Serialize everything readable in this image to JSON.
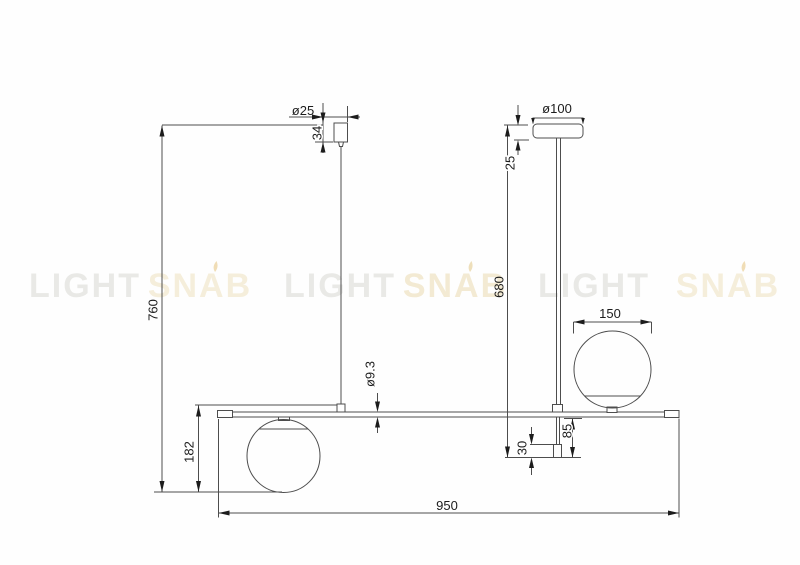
{
  "title": "Pendant lamp technical dimension drawing",
  "watermark": {
    "words": [
      "LIGHT",
      "SNAB",
      "LIGHT",
      "SNAB",
      "LIGHT",
      "SNAB"
    ],
    "gray_color": "#e9e9e6",
    "cream_color": "#f5eedb",
    "flame_color": "#f0ddb6"
  },
  "dimensions": {
    "small_canopy_diameter": "ø25",
    "small_canopy_height": "34",
    "large_canopy_diameter": "ø100",
    "large_canopy_height": "25",
    "total_height": "760",
    "rod_total_drop": "680",
    "bar_diameter": "ø9.3",
    "shade_diameter": "150",
    "left_shade_drop": "182",
    "end_tip_length": "30",
    "below_bar_drop": "85",
    "bar_length": "950"
  },
  "colors": {
    "line": "#4d4d4d",
    "dark": "#1c1c1c",
    "background": "#fefefe"
  }
}
